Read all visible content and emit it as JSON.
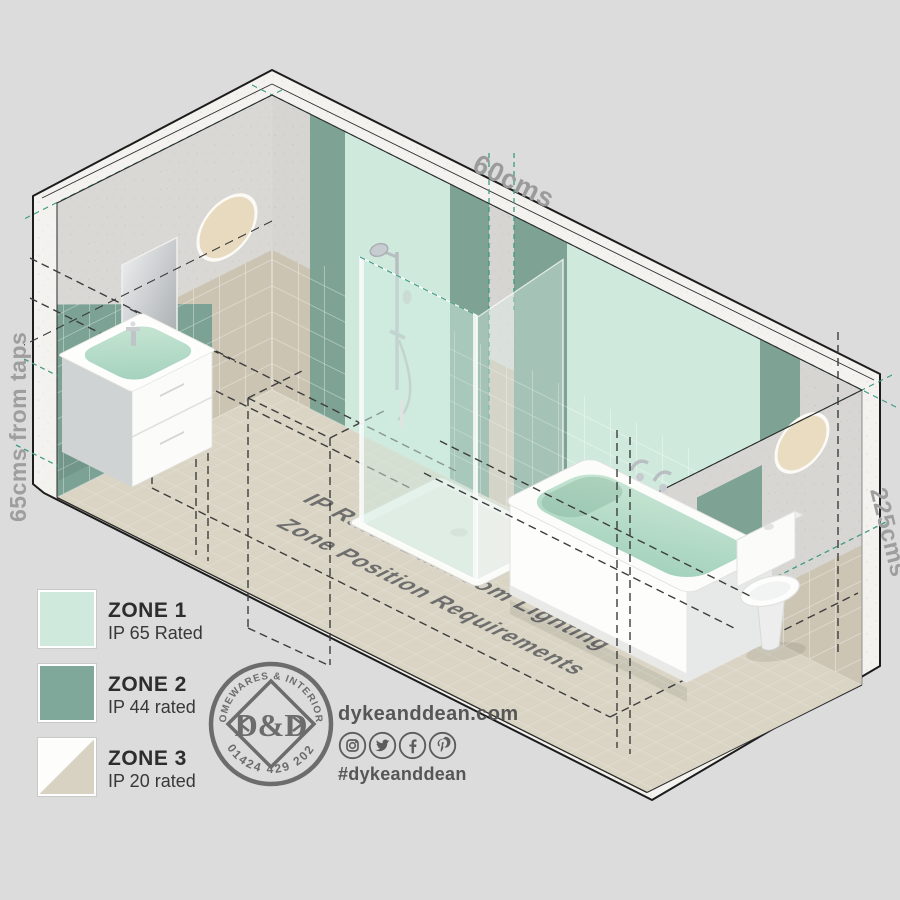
{
  "scene": {
    "floor_title_line1": "IP Rated Bathroom Lighting",
    "floor_title_line2": "Zone Position Requirements",
    "dim_top": "60cms",
    "dim_left": "65cms from taps",
    "dim_right": "225cms"
  },
  "legend": {
    "items": [
      {
        "zone": "ZONE 1",
        "rating": "IP 65 Rated",
        "swatch_color": "#cfeadd",
        "swatch_style": "solid"
      },
      {
        "zone": "ZONE 2",
        "rating": "IP 44 rated",
        "swatch_color": "#7fa79a",
        "swatch_style": "solid"
      },
      {
        "zone": "ZONE 3",
        "rating": "IP 20 rated",
        "swatch_color": "#d8d2c3",
        "swatch_style": "diagonal"
      }
    ]
  },
  "brand": {
    "logo_top_arc": "HOMEWARES & INTERIORS",
    "logo_monogram": "D&D",
    "logo_phone": "01424 429 202",
    "website": "dykeanddean.com",
    "hashtag": "#dykeanddean",
    "social_icons": [
      "instagram-icon",
      "twitter-icon",
      "facebook-icon",
      "pinterest-icon"
    ]
  },
  "colors": {
    "background": "#dcdcdc",
    "zone1_mint": "#cfeadd",
    "zone2_green": "#7fa79a",
    "zone3_beige": "#d8d2c3",
    "teal_dash": "#3f9a85",
    "black_dash": "#3d3d3d",
    "label_gray": "#9b9b9b",
    "brand_gray": "#6c6c6c"
  }
}
